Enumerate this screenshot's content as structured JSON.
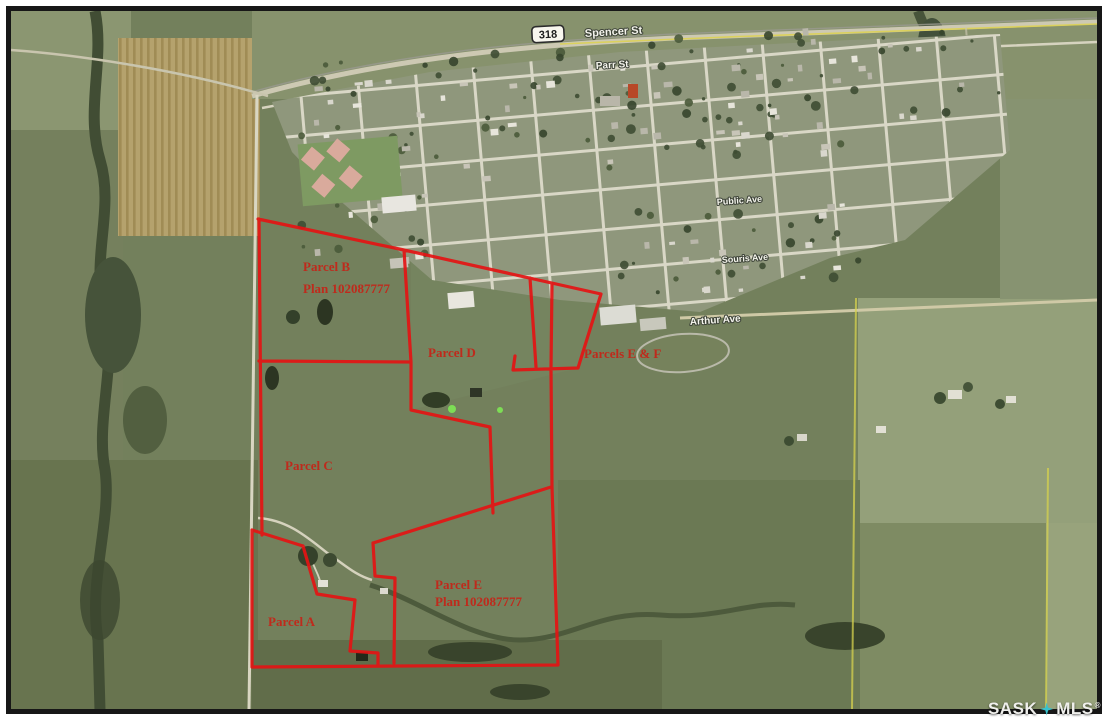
{
  "parcels": {
    "labels": [
      {
        "name": "Parcel B",
        "plan": "Plan 102087777"
      },
      {
        "name": "Parcel D",
        "plan": ""
      },
      {
        "name": "Parcels E & F",
        "plan": ""
      },
      {
        "name": "Parcel C",
        "plan": ""
      },
      {
        "name": "Parcel E",
        "plan": "Plan 102087777"
      },
      {
        "name": "Parcel A",
        "plan": ""
      }
    ],
    "boundary_color": "#e41414",
    "label_color": "#bf2a1c"
  },
  "streets": {
    "highway_shield": "318",
    "names": [
      "Spencer St",
      "Parr St",
      "Public Ave",
      "Souris Ave",
      "Arthur Ave"
    ]
  },
  "watermark": {
    "left": "SASK",
    "right": "MLS",
    "registered": "®",
    "icon": "four-point-star",
    "icon_color": "#38c1cd",
    "text_color": "#efefec"
  }
}
